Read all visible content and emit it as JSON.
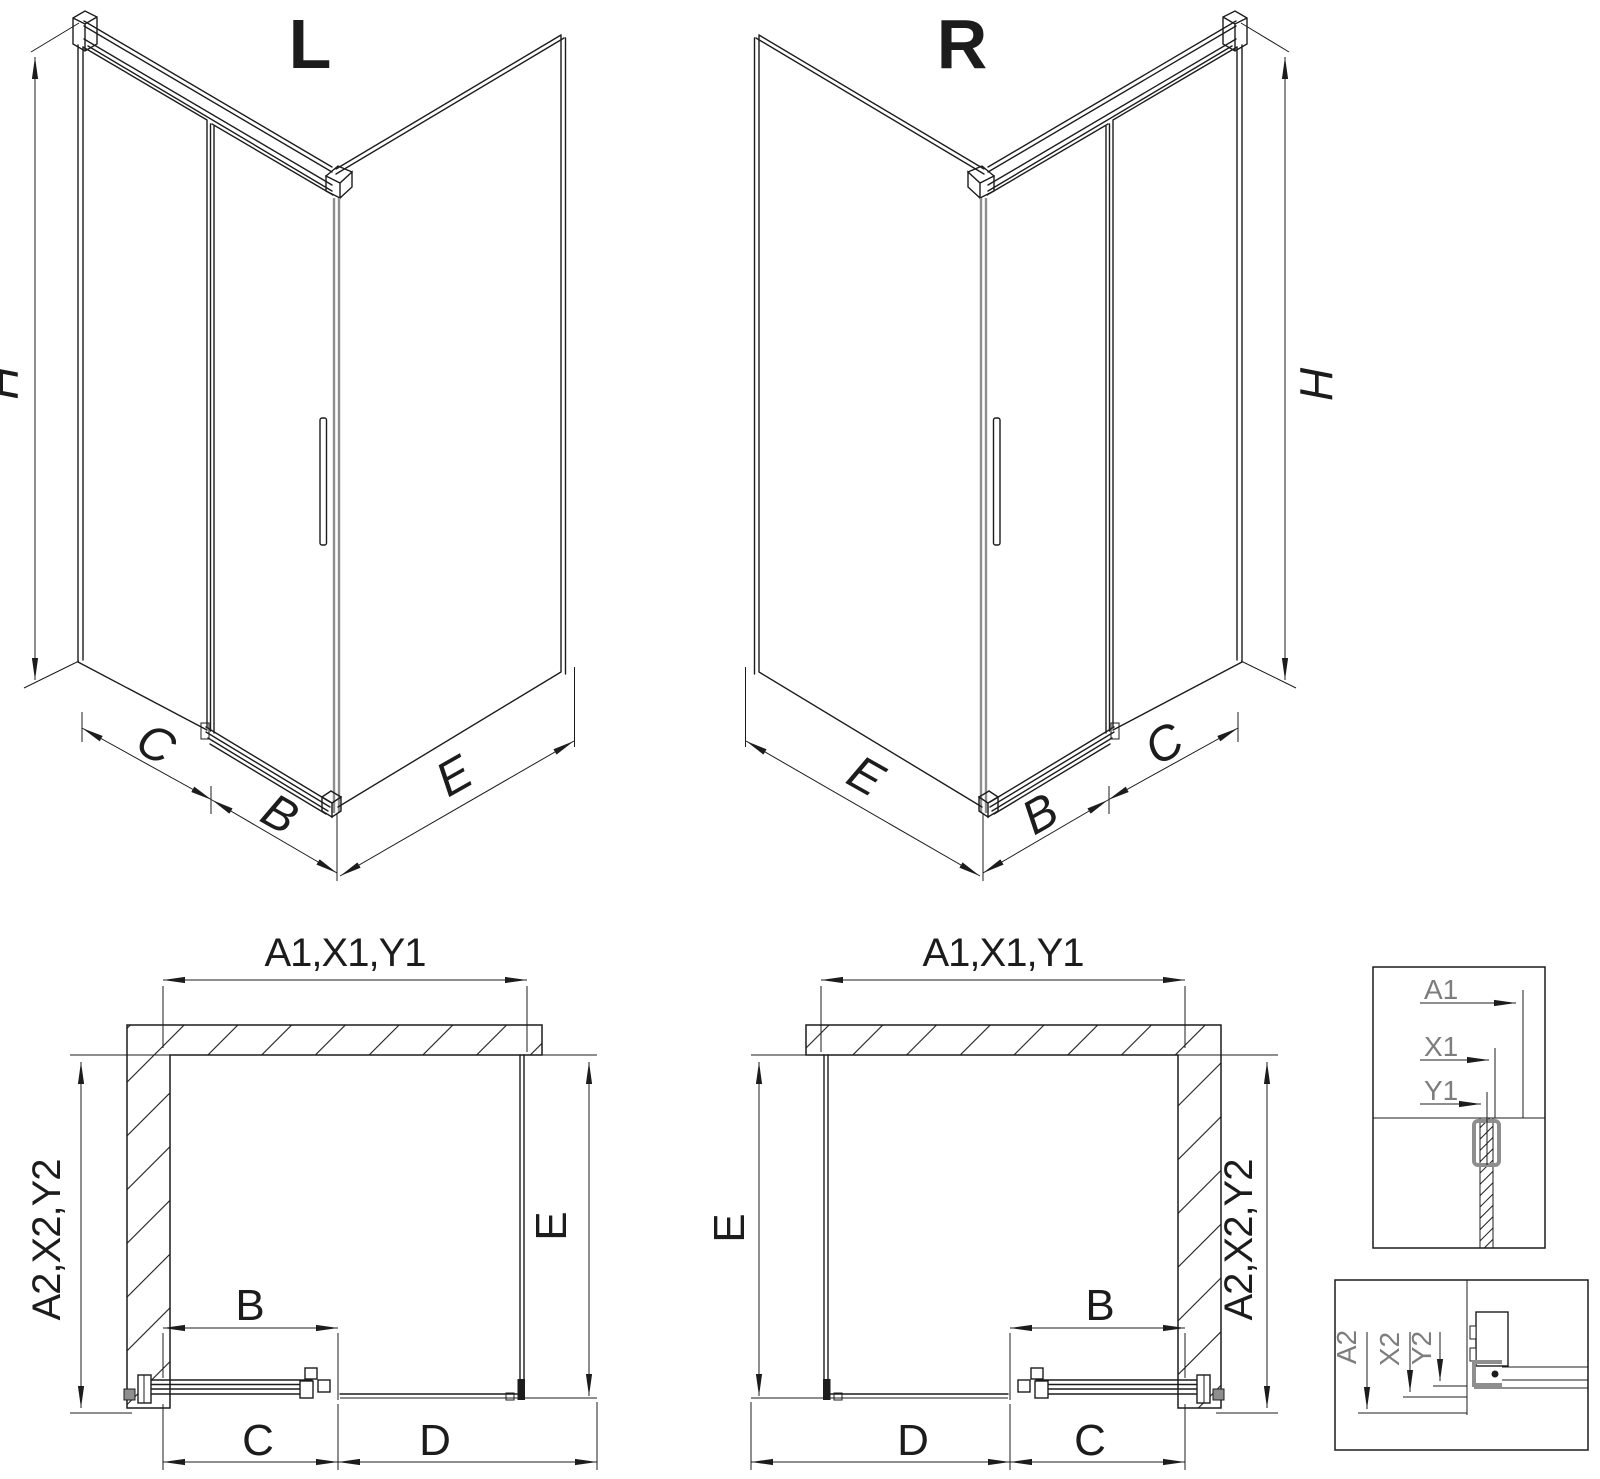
{
  "drawing": {
    "iso_left": {
      "label": "L",
      "dim_height": "H",
      "dims_bottom": [
        "C",
        "B",
        "E"
      ]
    },
    "iso_right": {
      "label": "R",
      "dim_height": "H",
      "dims_bottom": [
        "E",
        "B",
        "C"
      ]
    },
    "plan_left": {
      "dim_top": "A1,X1,Y1",
      "dim_left": "A2,X2,Y2",
      "dim_right": "E",
      "dim_door": "B",
      "dims_bottom": [
        "C",
        "D"
      ]
    },
    "plan_right": {
      "dim_top": "A1,X1,Y1",
      "dim_left": "E",
      "dim_right": "A2,X2,Y2",
      "dim_door": "B",
      "dims_bottom": [
        "D",
        "C"
      ]
    },
    "detail_top": {
      "dims": [
        "A1",
        "X1",
        "Y1"
      ]
    },
    "detail_bottom": {
      "dims": [
        "A2",
        "X2",
        "Y2"
      ]
    }
  },
  "colors": {
    "line": "#1c1c1c",
    "gray": "#8e8e8e",
    "detail": "#7d7d7d",
    "bg": "#ffffff"
  }
}
